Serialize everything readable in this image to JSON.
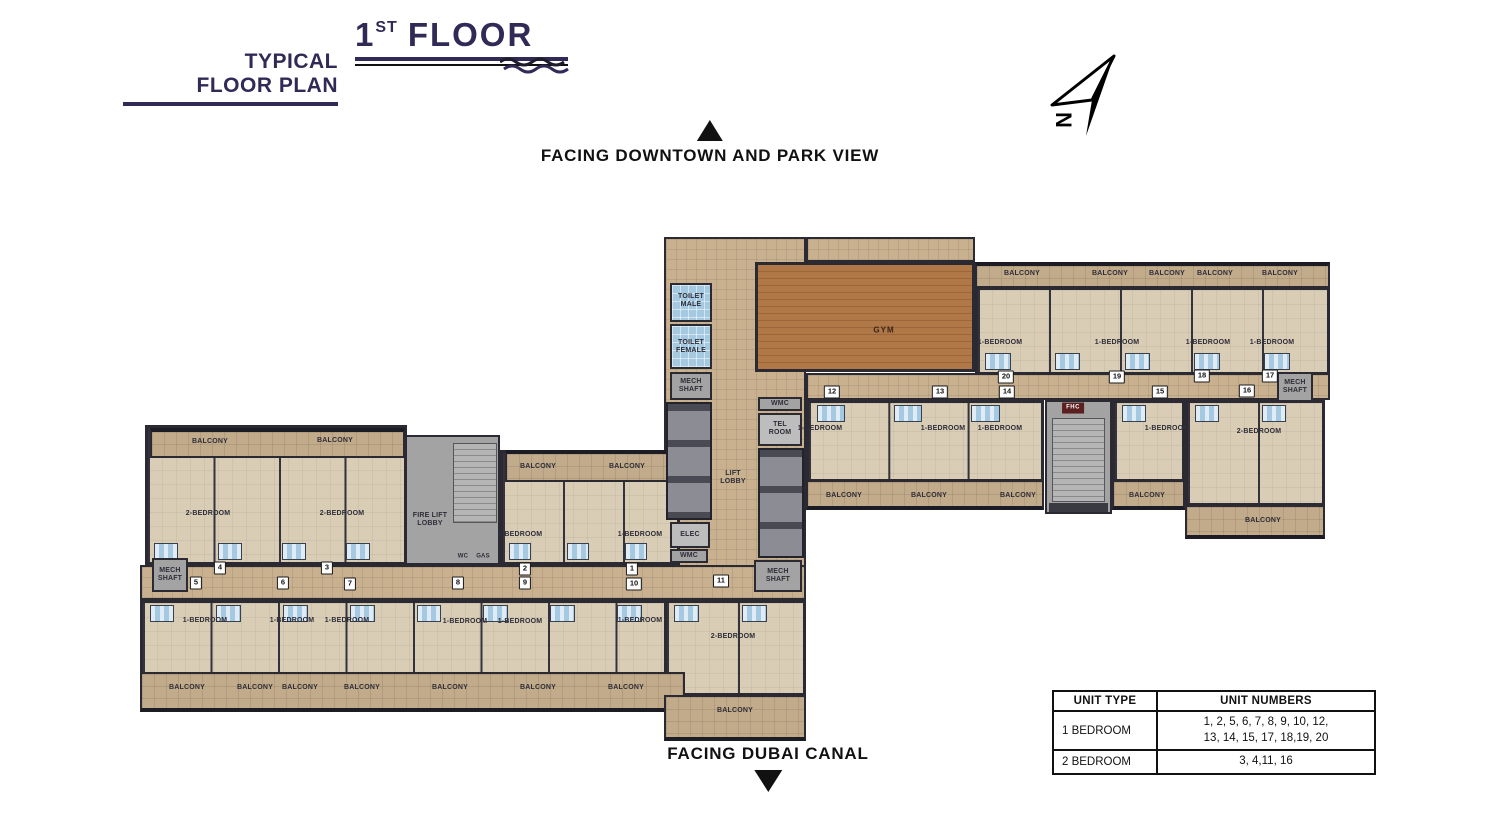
{
  "header": {
    "subtitle_line1": "TYPICAL",
    "subtitle_line2": "FLOOR PLAN",
    "floor_number": "1",
    "floor_sup": "ST",
    "floor_word": "FLOOR"
  },
  "orientation": {
    "top_label": "FACING DOWNTOWN AND PARK VIEW",
    "bottom_label": "FACING DUBAI CANAL",
    "north_letter": "N"
  },
  "legend_table": {
    "headers": [
      "UNIT TYPE",
      "UNIT NUMBERS"
    ],
    "rows": [
      {
        "type": "1 BEDROOM",
        "numbers": "1, 2, 5, 6, 7, 8, 9, 10, 12,\n13, 14, 15, 17, 18,19, 20"
      },
      {
        "type": "2 BEDROOM",
        "numbers": "3, 4,11, 16"
      }
    ]
  },
  "colors": {
    "title_navy": "#312a56",
    "wall_dark": "#2b2a33",
    "corridor_tan": "#c9b190",
    "balcony_tan": "#c2ab8a",
    "room_beige": "#d9cdb6",
    "bathroom_blue": "#a6c9e2",
    "gym_wood": "#b07747",
    "shaft_gray": "#a3a3a3",
    "fhc_red": "#5b1f1f"
  },
  "plan": {
    "labels": [
      {
        "text": "BALCONY",
        "x": 210,
        "y": 442
      },
      {
        "text": "BALCONY",
        "x": 335,
        "y": 441
      },
      {
        "text": "BALCONY",
        "x": 538,
        "y": 467
      },
      {
        "text": "BALCONY",
        "x": 627,
        "y": 467
      },
      {
        "text": "BALCONY",
        "x": 187,
        "y": 688
      },
      {
        "text": "BALCONY",
        "x": 255,
        "y": 688
      },
      {
        "text": "BALCONY",
        "x": 300,
        "y": 688
      },
      {
        "text": "BALCONY",
        "x": 362,
        "y": 688
      },
      {
        "text": "BALCONY",
        "x": 450,
        "y": 688
      },
      {
        "text": "BALCONY",
        "x": 538,
        "y": 688
      },
      {
        "text": "BALCONY",
        "x": 626,
        "y": 688
      },
      {
        "text": "BALCONY",
        "x": 735,
        "y": 711
      },
      {
        "text": "BALCONY",
        "x": 1022,
        "y": 274
      },
      {
        "text": "BALCONY",
        "x": 1110,
        "y": 274
      },
      {
        "text": "BALCONY",
        "x": 1167,
        "y": 274
      },
      {
        "text": "BALCONY",
        "x": 1215,
        "y": 274
      },
      {
        "text": "BALCONY",
        "x": 1280,
        "y": 274
      },
      {
        "text": "BALCONY",
        "x": 844,
        "y": 496
      },
      {
        "text": "BALCONY",
        "x": 929,
        "y": 496
      },
      {
        "text": "BALCONY",
        "x": 1018,
        "y": 496
      },
      {
        "text": "BALCONY",
        "x": 1147,
        "y": 496
      },
      {
        "text": "BALCONY",
        "x": 1263,
        "y": 521
      },
      {
        "text": "2-BEDROOM",
        "x": 208,
        "y": 514
      },
      {
        "text": "2-BEDROOM",
        "x": 342,
        "y": 514
      },
      {
        "text": "2-BEDROOM",
        "x": 733,
        "y": 637
      },
      {
        "text": "2-BEDROOM",
        "x": 1259,
        "y": 432
      },
      {
        "text": "1-BEDROOM",
        "x": 520,
        "y": 535
      },
      {
        "text": "1-BEDROOM",
        "x": 640,
        "y": 535
      },
      {
        "text": "1-BEDROOM",
        "x": 205,
        "y": 621
      },
      {
        "text": "1-BEDROOM",
        "x": 292,
        "y": 621
      },
      {
        "text": "1-BEDROOM",
        "x": 347,
        "y": 621
      },
      {
        "text": "1-BEDROOM",
        "x": 465,
        "y": 622
      },
      {
        "text": "1-BEDROOM",
        "x": 520,
        "y": 622
      },
      {
        "text": "1-BEDROOM",
        "x": 640,
        "y": 621
      },
      {
        "text": "1-BEDROOM",
        "x": 1000,
        "y": 343
      },
      {
        "text": "1-BEDROOM",
        "x": 1117,
        "y": 343
      },
      {
        "text": "1-BEDROOM",
        "x": 1208,
        "y": 343
      },
      {
        "text": "1-BEDROOM",
        "x": 1272,
        "y": 343
      },
      {
        "text": "1-BEDROOM",
        "x": 820,
        "y": 429
      },
      {
        "text": "1-BEDROOM",
        "x": 943,
        "y": 429
      },
      {
        "text": "1-BEDROOM",
        "x": 1000,
        "y": 429
      },
      {
        "text": "1-BEDROOM",
        "x": 1167,
        "y": 429
      },
      {
        "text": "TOILET\nMALE",
        "x": 691,
        "y": 301
      },
      {
        "text": "TOILET\nFEMALE",
        "x": 691,
        "y": 347
      },
      {
        "text": "MECH\nSHAFT",
        "x": 691,
        "y": 386
      },
      {
        "text": "WMC",
        "x": 780,
        "y": 404
      },
      {
        "text": "TEL\nROOM",
        "x": 780,
        "y": 429
      },
      {
        "text": "LIFT\nLOBBY",
        "x": 733,
        "y": 478
      },
      {
        "text": "ELEC",
        "x": 690,
        "y": 535
      },
      {
        "text": "WMC",
        "x": 689,
        "y": 556
      },
      {
        "text": "MECH\nSHAFT",
        "x": 778,
        "y": 576
      },
      {
        "text": "FIRE LIFT\nLOBBY",
        "x": 430,
        "y": 520
      },
      {
        "text": "WC",
        "x": 463,
        "y": 557,
        "cls": "xs"
      },
      {
        "text": "GAS",
        "x": 483,
        "y": 557,
        "cls": "xs"
      },
      {
        "text": "MECH\nSHAFT",
        "x": 170,
        "y": 575
      },
      {
        "text": "MECH\nSHAFT",
        "x": 1295,
        "y": 387
      },
      {
        "text": "GYM",
        "x": 884,
        "y": 330,
        "cls": "gym-label"
      },
      {
        "text": "FHC",
        "x": 1073,
        "y": 408,
        "cls": "fhc"
      }
    ],
    "units": [
      {
        "n": "1",
        "x": 632,
        "y": 569
      },
      {
        "n": "2",
        "x": 525,
        "y": 569
      },
      {
        "n": "3",
        "x": 327,
        "y": 568
      },
      {
        "n": "4",
        "x": 220,
        "y": 568
      },
      {
        "n": "5",
        "x": 196,
        "y": 583
      },
      {
        "n": "6",
        "x": 283,
        "y": 583
      },
      {
        "n": "7",
        "x": 350,
        "y": 584
      },
      {
        "n": "8",
        "x": 458,
        "y": 583
      },
      {
        "n": "9",
        "x": 525,
        "y": 583
      },
      {
        "n": "10",
        "x": 634,
        "y": 584
      },
      {
        "n": "11",
        "x": 721,
        "y": 581
      },
      {
        "n": "12",
        "x": 832,
        "y": 392
      },
      {
        "n": "13",
        "x": 940,
        "y": 392
      },
      {
        "n": "14",
        "x": 1007,
        "y": 392
      },
      {
        "n": "15",
        "x": 1160,
        "y": 392
      },
      {
        "n": "16",
        "x": 1247,
        "y": 391
      },
      {
        "n": "17",
        "x": 1270,
        "y": 376
      },
      {
        "n": "18",
        "x": 1202,
        "y": 376
      },
      {
        "n": "19",
        "x": 1117,
        "y": 377
      },
      {
        "n": "20",
        "x": 1006,
        "y": 377
      }
    ]
  }
}
